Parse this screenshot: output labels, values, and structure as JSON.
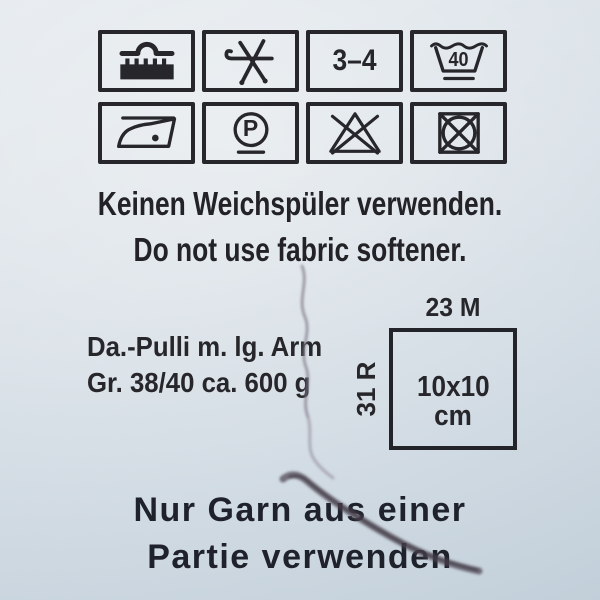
{
  "care_symbols": {
    "row1": [
      "machine-knitting",
      "hand-knitting-crossed-needles",
      "needle-size",
      "machine-wash-40"
    ],
    "row2": [
      "iron-one-dot",
      "dry-clean-p-mild",
      "do-not-bleach",
      "do-not-tumble-dry"
    ],
    "needle_size": "3–4",
    "wash_temperature": "40",
    "dry_clean_letter": "P"
  },
  "instructions": {
    "line_de": "Keinen Weichspüler verwenden.",
    "line_en": "Do not use fabric softener."
  },
  "garment": {
    "line1": "Da.-Pulli m. lg. Arm",
    "line2": "Gr. 38/40 ca. 600 g"
  },
  "gauge": {
    "stitches": "23 M",
    "rows": "31 R",
    "swatch_size": "10x10",
    "swatch_unit": "cm"
  },
  "dye_lot": {
    "line1": "Nur Garn aus einer",
    "line2": "Partie verwenden"
  },
  "colors": {
    "background": "#dde4ea",
    "ink": "#26262b",
    "bottom_text": "#1f222b"
  }
}
